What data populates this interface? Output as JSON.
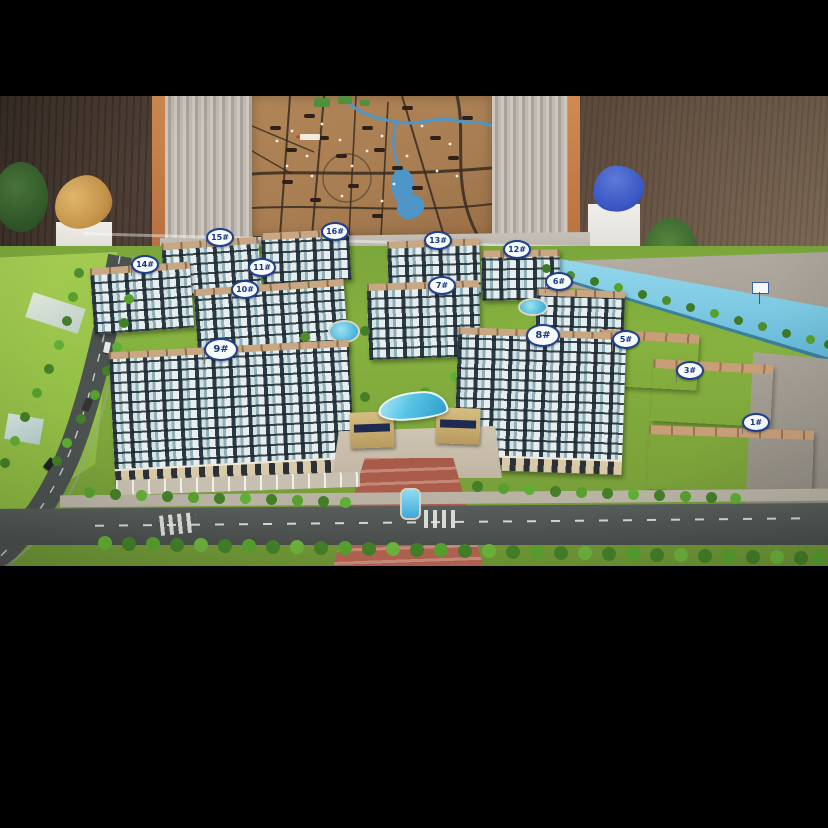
{
  "scene": {
    "type": "photograph",
    "subject": "architectural-scale-model-of-residential-development",
    "letterbox_color": "#000000"
  },
  "badges": [
    {
      "label": "15#"
    },
    {
      "label": "16#"
    },
    {
      "label": "13#"
    },
    {
      "label": "12#"
    },
    {
      "label": "14#"
    },
    {
      "label": "11#"
    },
    {
      "label": "10#"
    },
    {
      "label": "7#"
    },
    {
      "label": "6#"
    },
    {
      "label": "9#"
    },
    {
      "label": "8#"
    },
    {
      "label": "5#"
    },
    {
      "label": "3#"
    },
    {
      "label": "1#"
    }
  ],
  "palette": {
    "wall_left": "#4a3b31",
    "wall_right": "#6e5a49",
    "curtain": "#b8b2aa",
    "pillar_orange": "#c07a4a",
    "map_background": "#a87d52",
    "map_road": "#372b20",
    "map_water": "#4e95c8",
    "model_grass": "#86b23f",
    "canal_water": "#7cc8e2",
    "building_glass": "#d3e3e6",
    "building_frame": "#2b3a42",
    "roof_tan": "#c9a782",
    "entry_road_red": "#a85a48",
    "entrance_canopy_blue": "#57c4e6",
    "tree_green": "#4e8c2d",
    "badge_blue": "#1f3f8f",
    "gold_sculpture": "#c08f46",
    "blue_sculpture": "#3a57c4"
  }
}
